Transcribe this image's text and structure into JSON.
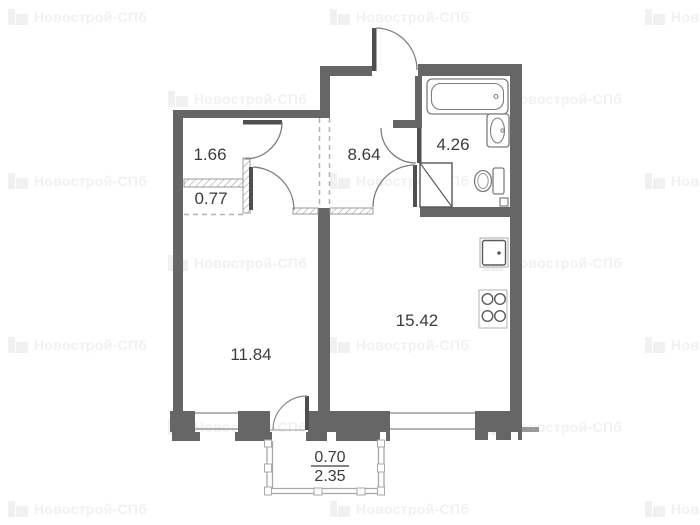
{
  "watermark": {
    "text": "Новострой-СПб",
    "icon": "building-icon",
    "color": "#f1f1f1"
  },
  "plan": {
    "rooms": [
      {
        "id": "closet-upper",
        "area": "1.66"
      },
      {
        "id": "closet-lower",
        "area": "0.77"
      },
      {
        "id": "hallway",
        "area": "8.64"
      },
      {
        "id": "bathroom",
        "area": "4.26"
      },
      {
        "id": "living-room",
        "area": "11.84"
      },
      {
        "id": "kitchen-living",
        "area": "15.42"
      }
    ],
    "balcony": {
      "area_counted": "0.70",
      "area_total": "2.35"
    },
    "fixtures": [
      "bathtub",
      "bath-sink",
      "toilet",
      "vent-shaft",
      "kitchen-sink",
      "stove"
    ],
    "colors": {
      "wall": "#666666",
      "door_leaf": "#4f4f4f",
      "swing_line": "#7d7d7d",
      "label": "#3c3c3c",
      "hatch": "#9b9b9b",
      "dash": "#b2b2b2",
      "balcony_line": "#a8a8a8"
    }
  }
}
